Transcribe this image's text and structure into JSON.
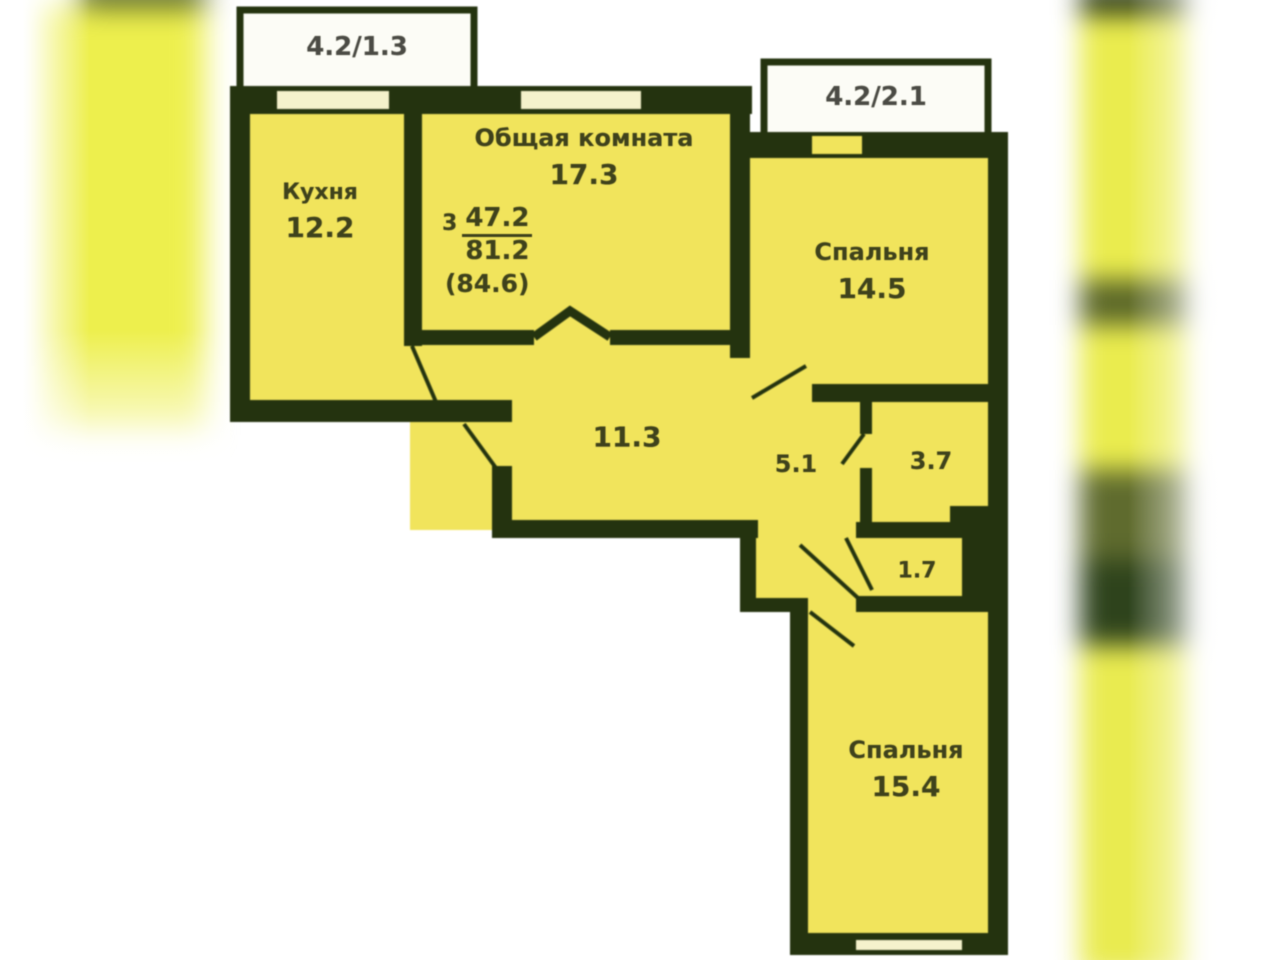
{
  "plan": {
    "balcony_left": {
      "label": "4.2/1.3"
    },
    "balcony_right": {
      "label": "4.2/2.1"
    },
    "living_room": {
      "name": "Общая комната",
      "area": "17.3"
    },
    "kitchen": {
      "name": "Кухня",
      "area": "12.2"
    },
    "bedroom_top": {
      "name": "Спальня",
      "area": "14.5"
    },
    "hallway": {
      "area": "11.3"
    },
    "corridor": {
      "area": "5.1"
    },
    "bathroom": {
      "area": "3.7"
    },
    "storage": {
      "area": "1.7"
    },
    "bedroom_bottom": {
      "name": "Спальня",
      "area": "15.4"
    },
    "summary": {
      "rooms_count": "3",
      "living_area": "47.2",
      "apartment_area": "81.2",
      "total_area": "(84.6)"
    },
    "colors": {
      "wall": "#24330f",
      "room_fill": "#f1e45c",
      "window_fill": "#f5f2cc",
      "balcony_fill": "#fcfcf6",
      "label_text": "#3f421c",
      "balcony_text": "#4b4b45"
    }
  }
}
